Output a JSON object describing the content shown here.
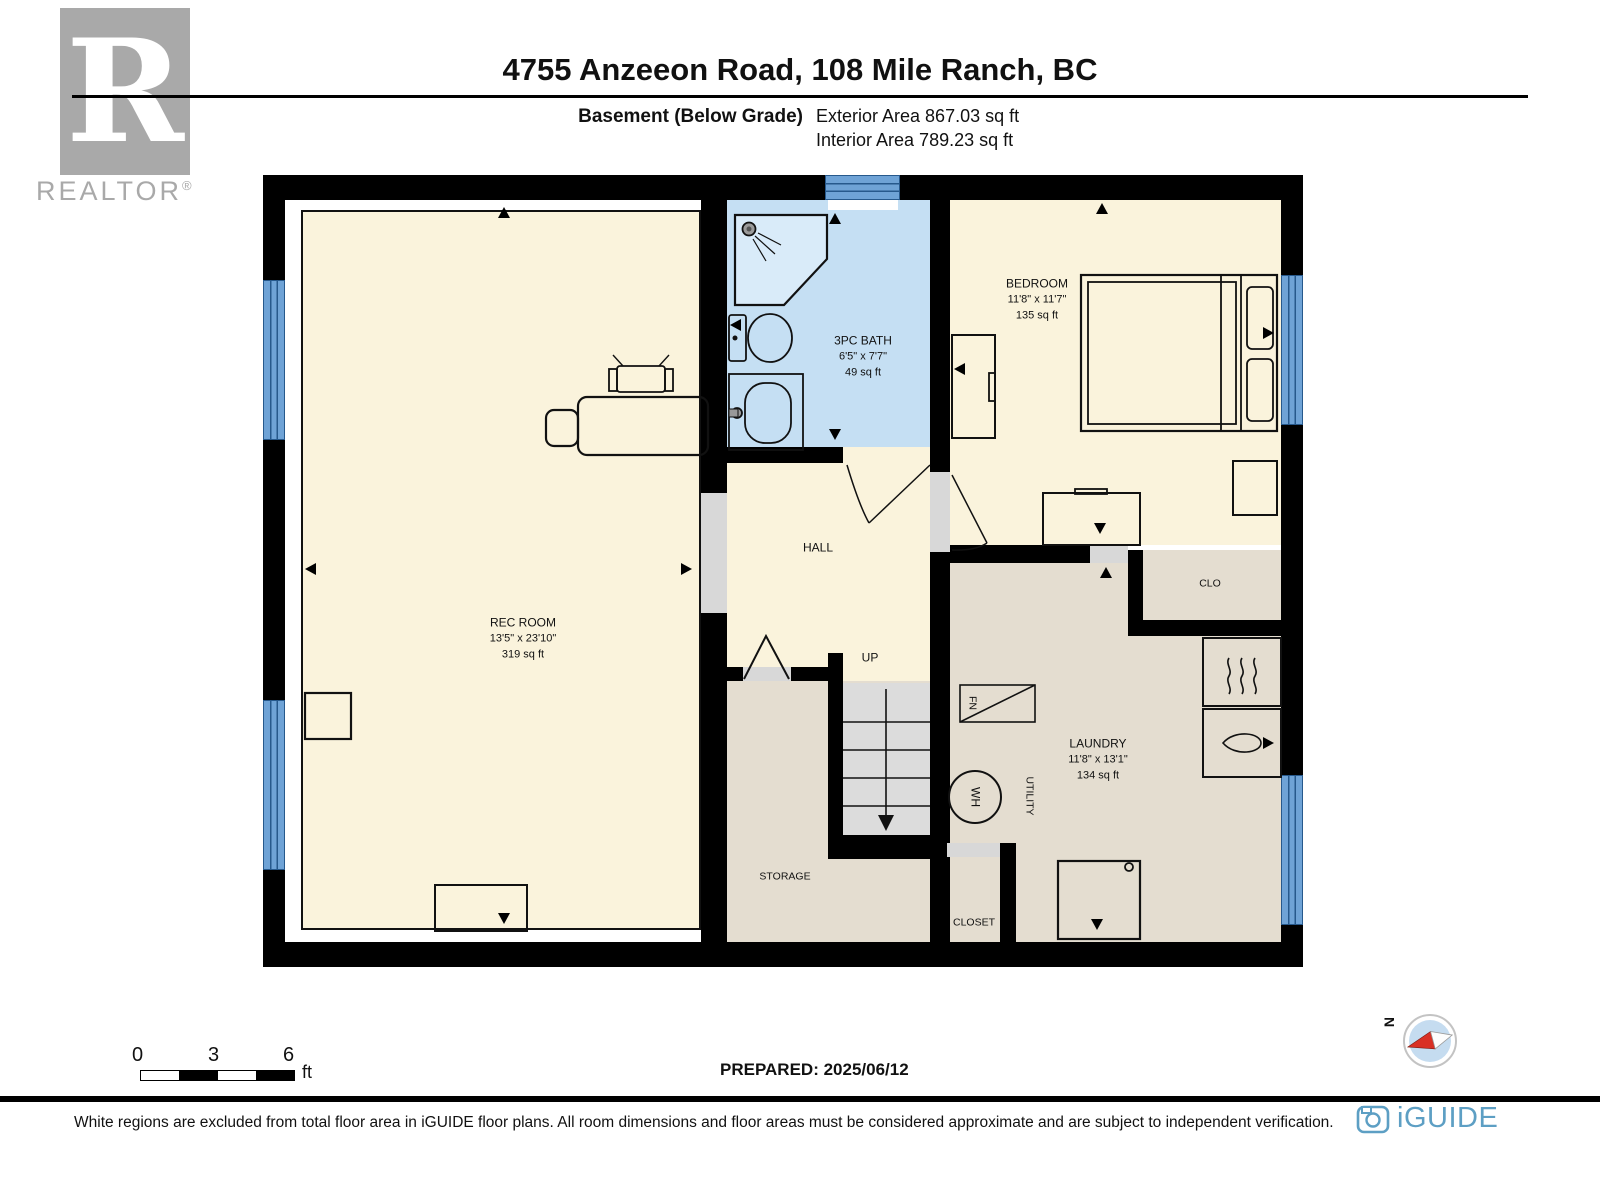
{
  "header": {
    "realtor_logo": {
      "letter": "R",
      "wordmark": "REALTOR",
      "registered": "®"
    },
    "title": "4755 Anzeeon Road, 108 Mile Ranch, BC",
    "floor_label": "Basement (Below Grade)",
    "exterior_area": "Exterior Area 867.03 sq ft",
    "interior_area": "Interior Area 789.23 sq ft"
  },
  "rooms": {
    "rec_room": {
      "name": "REC ROOM",
      "dims": "13'5\" x 23'10\"",
      "area": "319 sq ft"
    },
    "bath": {
      "name": "3PC BATH",
      "dims": "6'5\" x 7'7\"",
      "area": "49 sq ft"
    },
    "bedroom": {
      "name": "BEDROOM",
      "dims": "11'8\" x 11'7\"",
      "area": "135 sq ft"
    },
    "laundry": {
      "name": "LAUNDRY",
      "dims": "11'8\" x 13'1\"",
      "area": "134 sq ft"
    },
    "hall": {
      "name": "HALL"
    },
    "storage": {
      "name": "STORAGE"
    },
    "closet": {
      "name": "CLOSET"
    },
    "clo": {
      "name": "CLO"
    },
    "stairs_label": "UP",
    "utility_label": "UTILITY",
    "furnace_label": "FN",
    "water_heater_label": "WH"
  },
  "scale_bar": {
    "labels": [
      "0",
      "3",
      "6"
    ],
    "unit": "ft"
  },
  "prepared": "PREPARED: 2025/06/12",
  "compass": {
    "north_label": "N"
  },
  "footer": {
    "disclaimer": "White regions are excluded from total floor area in iGUIDE floor plans. All room dimensions and floor areas must be considered approximate and are subject to independent verification.",
    "brand": "iGUIDE"
  },
  "colors": {
    "wall": "#000000",
    "room_cream": "#FAF3DC",
    "bath_blue": "#C5DFF3",
    "laundry_beige": "#E4DDD0",
    "stair_gray": "#DCDCDC",
    "window_blue": "#6FA3D6",
    "window_line": "#27598C",
    "opening_gray": "#D8D8D8",
    "brand_blue": "#5D9FC4",
    "logo_gray": "#A9A9A9",
    "compass_red": "#D93025"
  }
}
